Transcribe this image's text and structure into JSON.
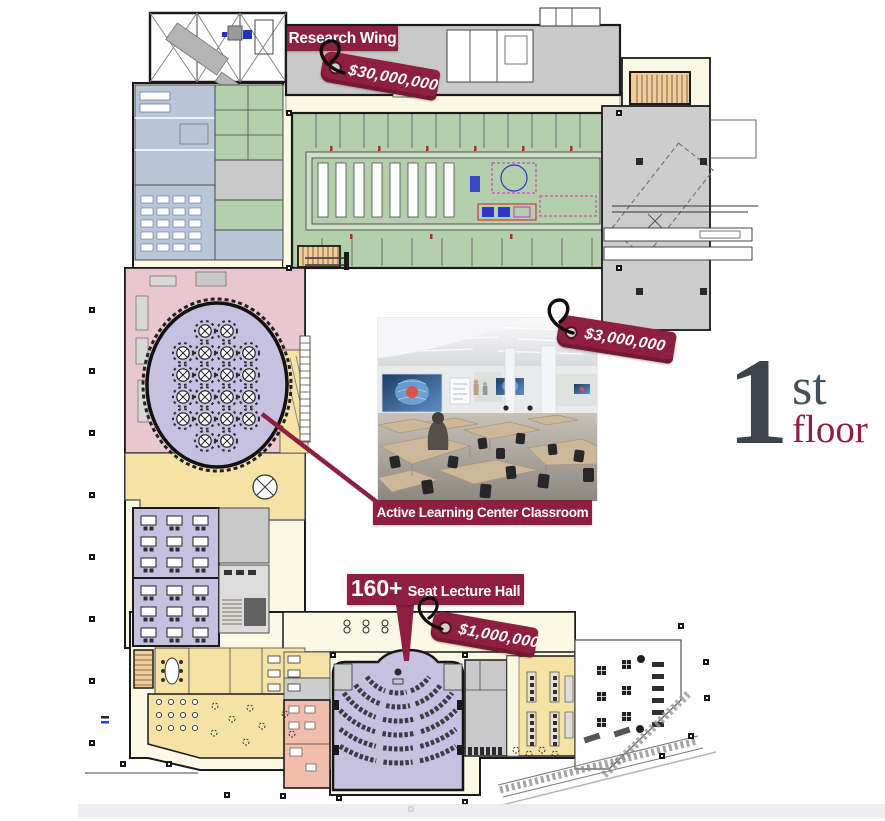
{
  "annotations": {
    "research_wing": {
      "label": "Research Wing",
      "price": "$30,000,000"
    },
    "active_learning_classroom": {
      "label": "Active Learning Center Classroom",
      "price": "$3,000,000"
    },
    "lecture_hall": {
      "seat_count": "160+",
      "label": "Seat Lecture Hall",
      "price": "$1,000,000"
    }
  },
  "floor_indicator": {
    "number": "1",
    "ordinal": "st",
    "word": "floor"
  },
  "colors": {
    "maroon": "#8e1f3e",
    "corridor_cream": "#fbf8e3",
    "labs_green": "#b3cfab",
    "labs_green_light": "#cfe0c7",
    "classroom_lavender": "#c6c1e0",
    "support_blue": "#b9c6da",
    "event_pink": "#eac6cf",
    "lobby_gold": "#f5e3a6",
    "gold_dark": "#ead381",
    "stair_tan": "#f2cc9b",
    "salmon": "#f2bdab",
    "shell_gray": "#c9c9c9",
    "light_gray": "#dcdcdc"
  }
}
